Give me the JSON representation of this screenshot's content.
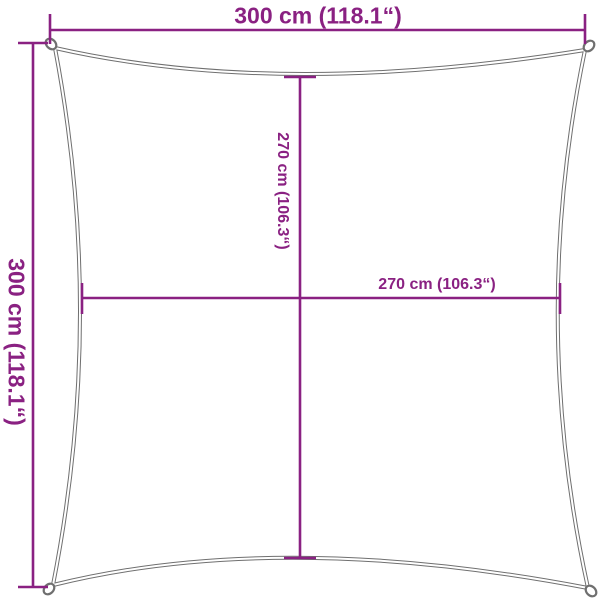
{
  "diagram": {
    "type": "product-dimension-diagram",
    "subject": "square shade sail with concave edges and corner rings",
    "labels": {
      "outer_width": "300 cm (118.1“)",
      "outer_height": "300 cm (118.1“)",
      "inner_height": "270 cm (106.3“)",
      "inner_width": "270 cm (106.3“)"
    },
    "measurements": [
      {
        "name": "outer-width",
        "value_cm": 300,
        "value_inches": 118.1
      },
      {
        "name": "outer-height",
        "value_cm": 300,
        "value_inches": 118.1
      },
      {
        "name": "inner-width",
        "value_cm": 270,
        "value_inches": 106.3
      },
      {
        "name": "inner-height",
        "value_cm": 270,
        "value_inches": 106.3
      }
    ],
    "colors": {
      "dimension_lines": "#8a2182",
      "sail_outline": "#6f6f6f",
      "background": "#ffffff"
    }
  }
}
